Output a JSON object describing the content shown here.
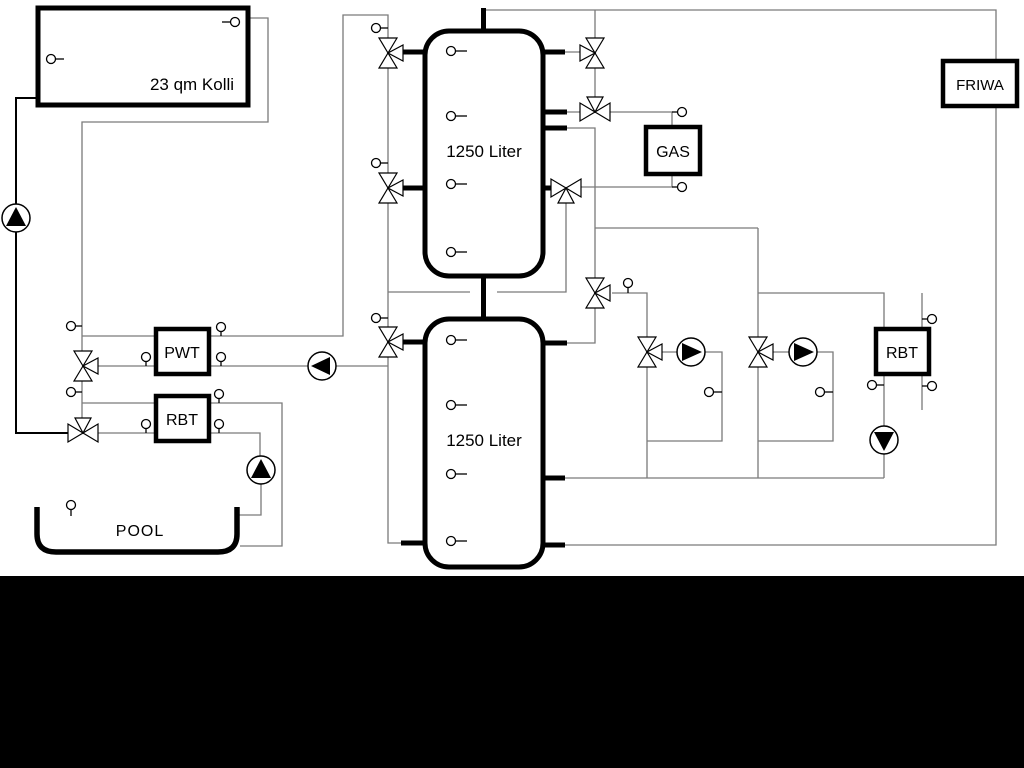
{
  "labels": {
    "collector": "23 qm Kolli",
    "tank1": "1250 Liter",
    "tank2": "1250 Liter",
    "pwt": "PWT",
    "rbt_left": "RBT",
    "gas": "GAS",
    "rbt_right": "RBT",
    "friwa": "FRIWA",
    "pool": "POOL"
  },
  "colors": {
    "pipe_gray": "#7a7a7a",
    "outline_black": "#000000",
    "background": "#ffffff",
    "footer_bar": "#000000"
  },
  "symbols": {
    "valve": "three-way-mixing-valve",
    "pump": "circulation-pump",
    "sensor": "temperature-sensor"
  }
}
